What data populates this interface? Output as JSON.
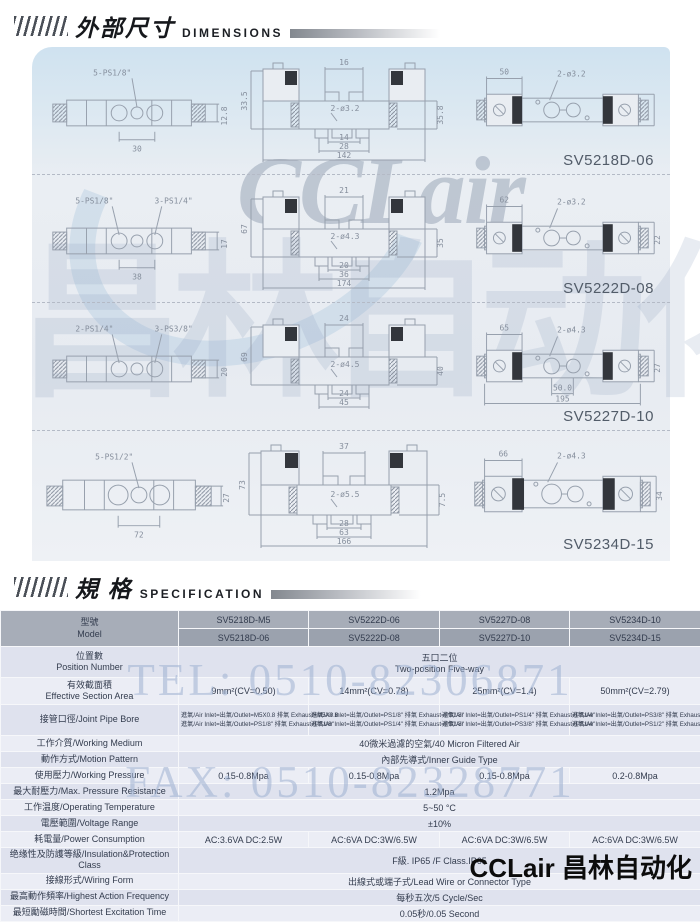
{
  "sections": {
    "dimensions": {
      "title_zh": "外部尺寸",
      "title_en": "DIMENSIONS"
    },
    "specification": {
      "title_zh": "規  格",
      "title_en": "SPECIFICATION"
    }
  },
  "watermark": {
    "brand": "CCLair",
    "chinese": "昌林自动化",
    "tel": "TEL: 0510-82306871",
    "fax": "FAX: 0510-82328771"
  },
  "footer_brand": "CCLair 昌林自动化",
  "drawings": {
    "rows": [
      {
        "model": "SV5218D-06",
        "left": {
          "port_label": "5-PS1/8\"",
          "port_label2": "",
          "width_dim": "30",
          "height_dim": "12.8"
        },
        "mid": {
          "left_dim": "33.5",
          "top_dim": "16",
          "hole_label": "2-ø3.2",
          "dim1": "14",
          "dim2": "28",
          "overall": "142",
          "right_dim": "35.8"
        },
        "right": {
          "top_dim": "50",
          "hole_label": "2-ø3.2",
          "right_dim": "",
          "dim1": "",
          "overall": ""
        }
      },
      {
        "model": "SV5222D-08",
        "left": {
          "port_label": "5-PS1/8\"",
          "port_label2": "3-PS1/4\"",
          "width_dim": "38",
          "height_dim": "17"
        },
        "mid": {
          "left_dim": "67",
          "top_dim": "21",
          "hole_label": "2-ø4.3",
          "dim1": "20",
          "dim2": "36",
          "overall": "174",
          "right_dim": "35"
        },
        "right": {
          "top_dim": "62",
          "hole_label": "2-ø3.2",
          "right_dim": "22",
          "dim1": "",
          "overall": ""
        }
      },
      {
        "model": "SV5227D-10",
        "left": {
          "port_label": "2-PS1/4\"",
          "port_label2": "3-PS3/8\"",
          "width_dim": "",
          "height_dim": "20"
        },
        "mid": {
          "left_dim": "69",
          "top_dim": "24",
          "hole_label": "2-ø4.5",
          "dim1": "24",
          "dim2": "45",
          "overall": "",
          "right_dim": "40"
        },
        "right": {
          "top_dim": "65",
          "hole_label": "2-ø4.3",
          "right_dim": "27",
          "dim1": "50.0",
          "overall": "195"
        }
      },
      {
        "model": "SV5234D-15",
        "left": {
          "port_label": "5-PS1/2\"",
          "port_label2": "",
          "width_dim": "72",
          "height_dim": "27"
        },
        "mid": {
          "left_dim": "73",
          "top_dim": "37",
          "hole_label": "2-ø5.5",
          "dim1": "28",
          "dim2": "63",
          "overall": "166",
          "right_dim": "7.5"
        },
        "right": {
          "top_dim": "66",
          "hole_label": "2-ø4.3",
          "right_dim": "34",
          "dim1": "",
          "overall": ""
        }
      }
    ]
  },
  "spec": {
    "header": {
      "label_zh": "型號",
      "label_en": "Model",
      "models_a": [
        "SV5218D-M5",
        "SV5222D-06",
        "SV5227D-08",
        "SV5234D-10"
      ],
      "models_b": [
        "SV5218D-06",
        "SV5222D-08",
        "SV5227D-10",
        "SV5234D-15"
      ]
    },
    "rows": [
      {
        "label": "位置數",
        "label2": "Position Number",
        "span": "五口二位",
        "span2": "Two-position Five-way"
      },
      {
        "label": "有效截面積",
        "label2": "Effective Section Area",
        "cells": [
          "9mm²(CV=0.50)",
          "14mm²(CV=0.78)",
          "25mm²(CV=1.4)",
          "50mm²(CV=2.79)"
        ]
      },
      {
        "label": "接管口徑/Joint Pipe Bore",
        "cells_a": [
          "進氣/Air Inlet=出氣/Outlet=M5X0.8 排氣 Exhaust=M5X0.8",
          "進氣/Air Inlet=出氣/Outlet=PS1/8\" 排氣 Exhaust=PS1/8\"",
          "進氣/Air Inlet=出氣/Outlet=PS1/4\" 排氣 Exhaust=PS1/4\"",
          "進氣/Air Inlet=出氣/Outlet=PS3/8\" 排氣 Exhaust=PS3/8\""
        ],
        "cells_b": [
          "進氣/Air Inlet=出氣/Outlet=PS1/8\" 排氣 Exhaust=PS1/8\"",
          "進氣/Air Inlet=出氣/Outlet=PS1/4\" 排氣 Exhaust=PS1/8\"",
          "進氣/Air Inlet=出氣/Outlet=PS3/8\" 排氣 Exhaust=PS1/4\"",
          "進氣/Air Inlet=出氣/Outlet=PS1/2\" 排氣 Exhaust=PS1/2\""
        ]
      },
      {
        "label": "工作介質/Working Medium",
        "span": "40微米過濾的空氣/40 Micron Filtered Air"
      },
      {
        "label": "動作方式/Motion Pattern",
        "span": "內部先導式/Inner Guide Type"
      },
      {
        "label": "使用壓力/Working Pressure",
        "cells": [
          "0.15-0.8Mpa",
          "0.15-0.8Mpa",
          "0.15-0.8Mpa",
          "0.2-0.8Mpa"
        ]
      },
      {
        "label": "最大耐壓力/Max. Pressure Resistance",
        "span": "1.2Mpa"
      },
      {
        "label": "工作温度/Operating Temperature",
        "span": "5~50 °C"
      },
      {
        "label": "電壓範圍/Voltage Range",
        "span": "±10%"
      },
      {
        "label": "耗電量/Power Consumption",
        "cells": [
          "AC:3.6VA   DC:2.5W",
          "AC:6VA   DC:3W/6.5W",
          "AC:6VA   DC:3W/6.5W",
          "AC:6VA   DC:3W/6.5W"
        ]
      },
      {
        "label": "绝缘性及防護等級/Insulation&Protection Class",
        "span": "F級. IP65 /F Class.IP65"
      },
      {
        "label": "接線形式/Wiring Form",
        "span": "出線式或端子式/Lead Wire or Connector Type"
      },
      {
        "label": "最高動作頻率/Highest Action Frequency",
        "span": "每秒五次/5 Cycle/Sec"
      },
      {
        "label": "最短勵磁時間/Shortest Excitation Time",
        "span": "0.05秒/0.05 Second"
      }
    ]
  }
}
